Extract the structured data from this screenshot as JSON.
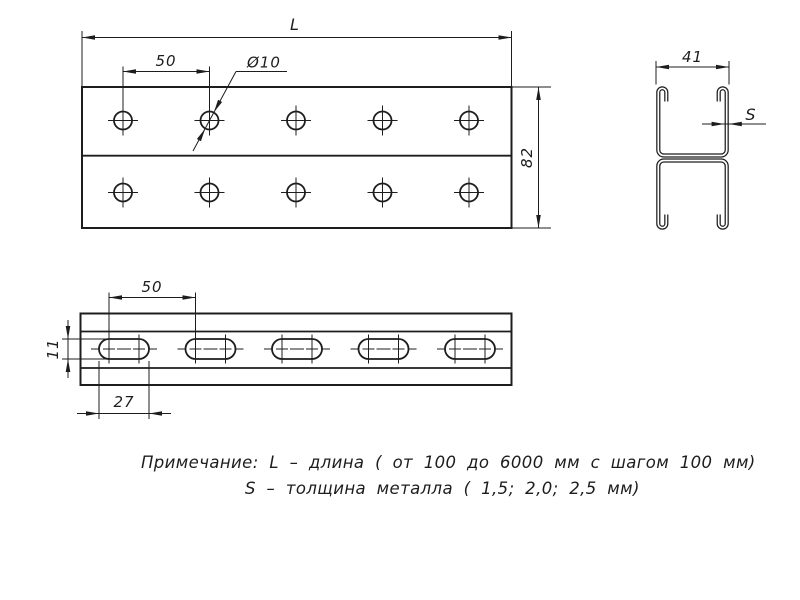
{
  "drawing": {
    "top_view": {
      "length_label": "L",
      "hole_spacing": "50",
      "hole_diameter": "Ø10",
      "height": "82",
      "hole_count": 10,
      "hole_rows": 2
    },
    "section_view": {
      "width": "41",
      "thickness_label": "S"
    },
    "side_view": {
      "slot_spacing": "50",
      "slot_height": "11",
      "slot_length": "27",
      "slot_count": 5
    },
    "notes": {
      "line1": "Примечание: L – длина ( от 100 до 6000 мм с шагом 100 мм)",
      "line2": "S – толщина металла ( 1,5; 2,0; 2,5 мм)"
    },
    "colors": {
      "line": "#1d1d1d",
      "background": "#ffffff"
    }
  }
}
